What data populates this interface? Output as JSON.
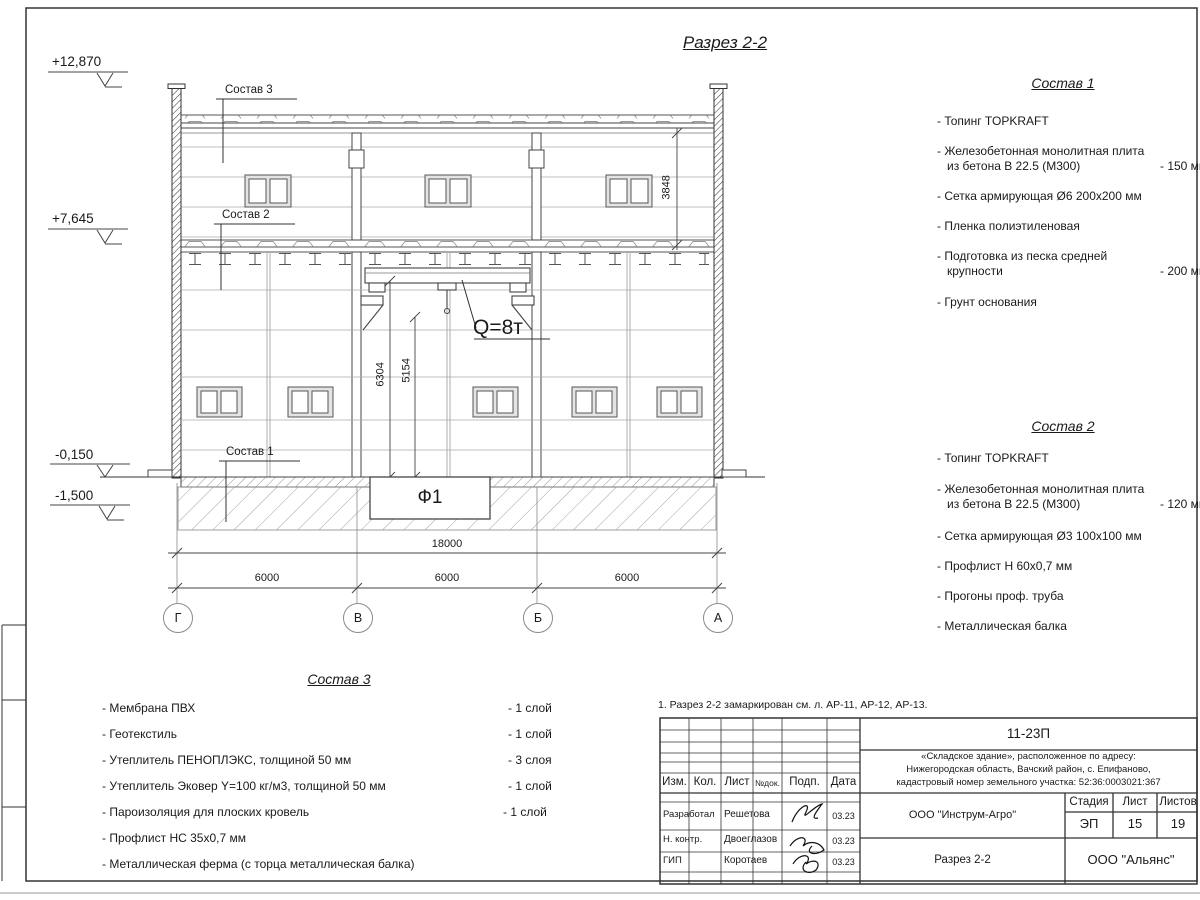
{
  "sheet": {
    "title": "Разрез 2-2",
    "note": "1. Разрез 2-2 замаркирован см. л. АР-11, АР-12, АР-13."
  },
  "section": {
    "elevations": {
      "top": "+12,870",
      "floor2": "+7,645",
      "ground": "-0,150",
      "base": "-1,500"
    },
    "labels": {
      "roof_ref": "Состав 3",
      "floor_ref": "Состав 2",
      "slab_ref": "Состав 1",
      "crane": "Q=8т",
      "foundation": "Ф1"
    },
    "dims": {
      "clear2": "3848",
      "hook1": "6304",
      "hook2": "5154",
      "total": "18000",
      "bay1": "6000",
      "bay2": "6000",
      "bay3": "6000"
    },
    "axes": {
      "g": "Г",
      "v": "В",
      "b": "Б",
      "a": "А"
    }
  },
  "sostav1": {
    "heading": "Состав 1",
    "items": [
      {
        "t": "- Топинг TOPKRAFT",
        "t2": "",
        "v": ""
      },
      {
        "t": "- Железобетонная  монолитная плита",
        "t2": "из бетона  В 22.5 (М300)",
        "v": "- 150 мм"
      },
      {
        "t": "- Сетка армирующая Ø6 200х200 мм",
        "t2": "",
        "v": ""
      },
      {
        "t": "- Пленка полиэтиленовая",
        "t2": "",
        "v": ""
      },
      {
        "t": "- Подготовка из песка средней",
        "t2": "крупности",
        "v": "- 200 мм"
      },
      {
        "t": "- Грунт основания",
        "t2": "",
        "v": ""
      }
    ]
  },
  "sostav2": {
    "heading": "Состав 2",
    "items": [
      {
        "t": "- Топинг TOPKRAFT",
        "t2": "",
        "v": ""
      },
      {
        "t": "- Железобетонная  монолитная плита",
        "t2": "из бетона  В 22.5 (М300)",
        "v": "- 120 мм"
      },
      {
        "t": "- Сетка армирующая Ø3 100х100 мм",
        "t2": "",
        "v": ""
      },
      {
        "t": "- Профлист Н 60х0,7 мм",
        "t2": "",
        "v": ""
      },
      {
        "t": "- Прогоны проф. труба",
        "t2": "",
        "v": ""
      },
      {
        "t": "- Металлическая балка",
        "t2": "",
        "v": ""
      }
    ]
  },
  "sostav3": {
    "heading": "Состав 3",
    "items": [
      {
        "t": "- Мембрана ПВХ",
        "v": "- 1 слой"
      },
      {
        "t": "- Геотекстиль",
        "v": "- 1 слой"
      },
      {
        "t": "- Утеплитель ПЕНОПЛЭКС, толщиной 50 мм",
        "v": "- 3 слоя"
      },
      {
        "t": "- Утеплитель Эковер Y=100 кг/м3, толщиной 50 мм",
        "v": "- 1 слой"
      },
      {
        "t": "- Пароизоляция для плоских кровель",
        "v": "- 1 слой"
      },
      {
        "t": "- Профлист НС 35х0,7 мм",
        "v": ""
      },
      {
        "t": "- Металлическая ферма (с торца металлическая балка)",
        "v": ""
      }
    ]
  },
  "titleblock": {
    "doc_number": "11-23П",
    "project_line1": "«Складское здание», расположенное по адресу:",
    "project_line2": "Нижегородская область, Вачский район, с. Епифаново,",
    "project_line3": "кадастровый номер земельного участка: 52:36:0003021:367",
    "cols": {
      "izm": "Изм.",
      "kol": "Кол.",
      "list": "Лист",
      "ndok": "№док.",
      "podp": "Подп.",
      "data": "Дата"
    },
    "rows": [
      {
        "role": "Разработал",
        "name": "Решетова",
        "date": "03.23"
      },
      {
        "role": "Н. контр.",
        "name": "Двоеглазов",
        "date": "03.23"
      },
      {
        "role": "ГИП",
        "name": "Коротаев",
        "date": "03.23"
      }
    ],
    "org": "ООО \"Инструм-Агро\"",
    "stage_label": "Стадия",
    "sheet_label": "Лист",
    "sheets_label": "Листов",
    "stage": "ЭП",
    "sheet": "15",
    "sheets": "19",
    "drawing_name": "Разрез 2-2",
    "company": "ООО \"Альянс\""
  }
}
